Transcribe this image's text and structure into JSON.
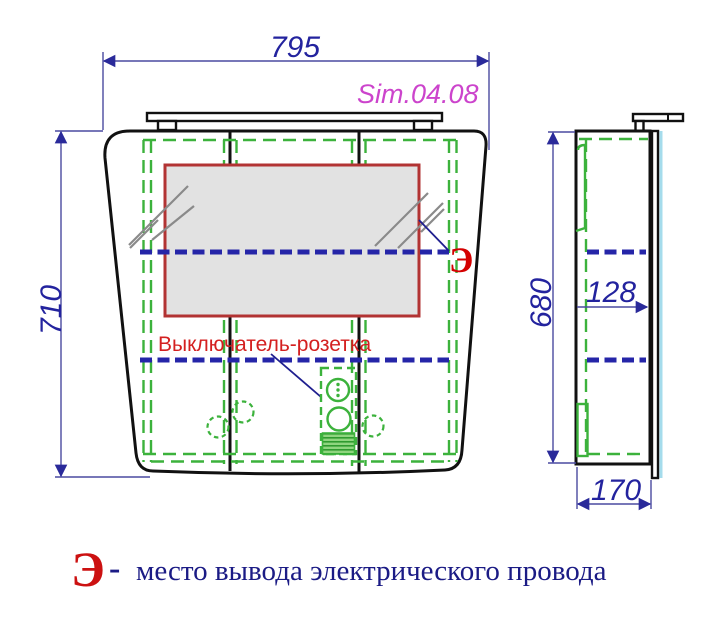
{
  "product": {
    "model": "Sim.04.08"
  },
  "dimensions": {
    "overall_width": "795",
    "overall_height": "710",
    "carcass_height": "680",
    "shelf_offset": "128",
    "depth": "170"
  },
  "annotations": {
    "switch_socket_label": "Выключатель-розетка",
    "electric_marker": "Э"
  },
  "legend": {
    "marker": "Э",
    "separator": "-",
    "text": "место вывода электрического провода"
  },
  "colors": {
    "dimension_blue": "#23239e",
    "model_magenta": "#cc44cc",
    "accent_red": "#d42020",
    "marker_red": "#d40000",
    "drawing_green": "#3cb23c",
    "shelf_blue": "#2525a8",
    "mirror_border_red": "#b23333",
    "mirror_fill_gray": "#e2e2e2",
    "glass_edge_cyan": "#a5dcec",
    "outline_black": "#111111"
  }
}
